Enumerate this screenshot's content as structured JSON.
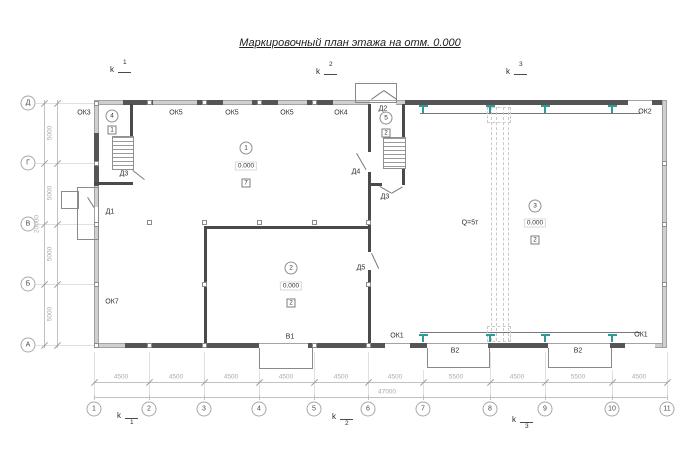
{
  "title": "Маркировочный план этажа на отм. 0.000",
  "grid": {
    "cols": [
      "1",
      "2",
      "3",
      "4",
      "5",
      "6",
      "7",
      "8",
      "9",
      "10",
      "11"
    ],
    "rows": [
      "Д",
      "Г",
      "В",
      "Б",
      "А"
    ]
  },
  "dims": {
    "bays_bottom": [
      "4500",
      "4500",
      "4500",
      "4500",
      "4500",
      "4500",
      "5500",
      "4500",
      "5500",
      "4500"
    ],
    "total_bottom": "47000",
    "bays_left": [
      "5000",
      "5000",
      "5000",
      "5000"
    ],
    "total_left": "20000"
  },
  "sections": {
    "letter": "k",
    "n1": "1",
    "n2": "2",
    "n3": "3"
  },
  "rooms": {
    "r1": {
      "num": "1",
      "elev": "0.000",
      "type": "7"
    },
    "r2": {
      "num": "2",
      "elev": "0.000",
      "type": "2"
    },
    "r3": {
      "num": "3",
      "elev": "0.000",
      "type": "2"
    },
    "r4": {
      "num": "4",
      "type": "1"
    },
    "r5": {
      "num": "5",
      "type": "2"
    }
  },
  "marks": {
    "ok1_left": "ОК1",
    "ok1_right": "ОК1",
    "ok2": "ОК2",
    "ok3": "ОК3",
    "ok4": "ОК4",
    "ok5_1": "ОК5",
    "ok5_2": "ОК5",
    "ok5_3": "ОК5",
    "ok7": "ОК7",
    "d1": "Д1",
    "d2": "Д2",
    "d3_left": "Д3",
    "d3_mid": "Д3",
    "d4": "Д4",
    "d5": "Д5",
    "v1": "В1",
    "v2_left": "В2",
    "v2_right": "В2"
  },
  "crane": {
    "capacity": "Q=5т"
  },
  "colors": {
    "steel_column": "#2e9b9b",
    "wall_dark": "#555555",
    "wall_light": "#cfcfcf"
  }
}
